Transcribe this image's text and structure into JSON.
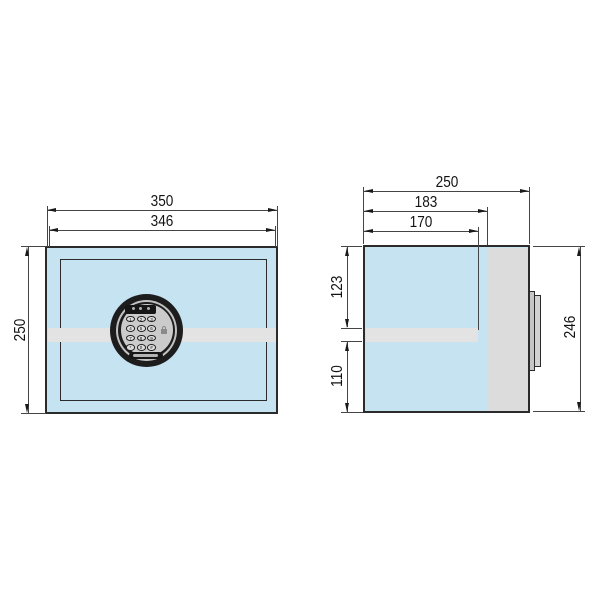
{
  "views": {
    "front": {
      "dimensions": {
        "outer_width": "350",
        "door_width": "346",
        "height": "250"
      },
      "keypad": {
        "buttons": [
          "1",
          "2",
          "3",
          "4",
          "5",
          "6",
          "7",
          "8",
          "9",
          "*",
          "0",
          "#"
        ]
      }
    },
    "side": {
      "dimensions": {
        "depth_total": "250",
        "depth_body": "183",
        "depth_door": "170",
        "height_upper": "123",
        "height_lower": "110",
        "height_back": "246"
      }
    }
  },
  "icons": {
    "padlock": "padlock-icon"
  },
  "colors": {
    "body_fill": "#c6e3f1",
    "back_panel_fill": "#dcdcdc",
    "highlight_band": "#e3e3e3",
    "outline": "#2b2b2b",
    "dimension_line": "#454545",
    "keypad_dark": "#1d1d1d",
    "keypad_panel": "#cbcbcb"
  }
}
